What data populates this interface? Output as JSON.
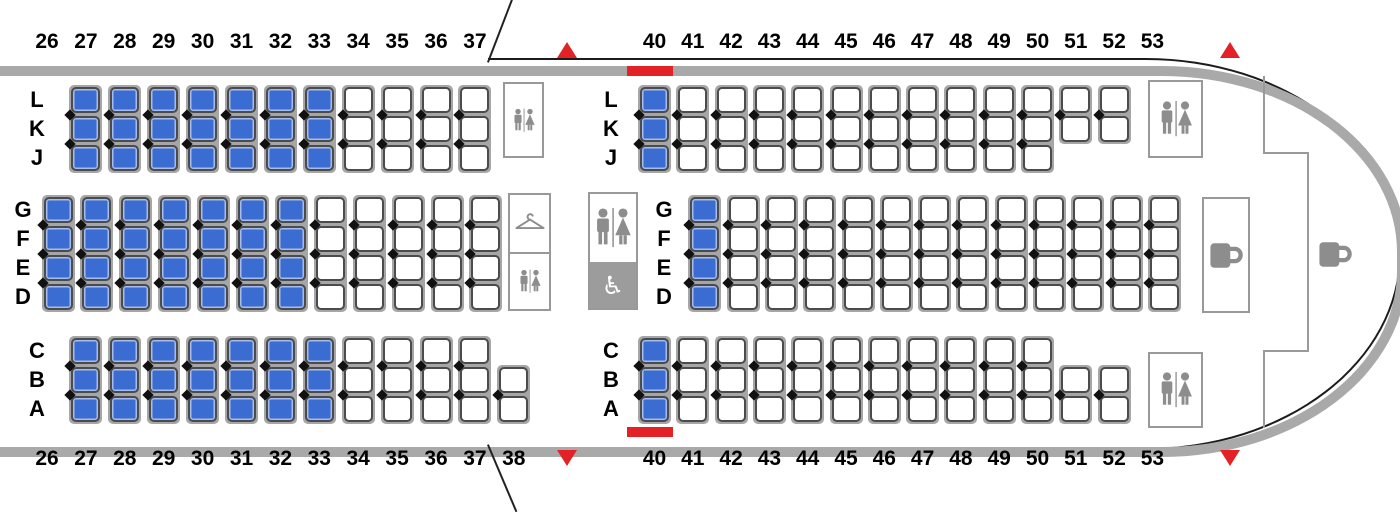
{
  "seat_map": {
    "colors": {
      "seat_highlight": "#3b6cd2",
      "seat_outline": "#4b4b4b",
      "seat_frame_gray": "#a6a6a6",
      "fuselage_gray": "#a9a9a9",
      "aft_outline_black": "#1c1c1c",
      "exit_red": "#e32227",
      "facility_border": "#999999",
      "icon_gray": "#8d8d8d",
      "accessible_lav_bg": "#9c9c9c"
    },
    "row_numbers": {
      "top_left": [
        "26",
        "27",
        "28",
        "29",
        "30",
        "31",
        "32",
        "33",
        "34",
        "35",
        "36",
        "37"
      ],
      "top_right": [
        "40",
        "41",
        "42",
        "43",
        "44",
        "45",
        "46",
        "47",
        "48",
        "49",
        "50",
        "51",
        "52",
        "53"
      ],
      "bottom_left": [
        "26",
        "27",
        "28",
        "29",
        "30",
        "31",
        "32",
        "33",
        "34",
        "35",
        "36",
        "37",
        "38"
      ],
      "bottom_right": [
        "40",
        "41",
        "42",
        "43",
        "44",
        "45",
        "46",
        "47",
        "48",
        "49",
        "50",
        "51",
        "52",
        "53"
      ]
    },
    "cabin_blocks": [
      {
        "id": "fwd-top",
        "letters": [
          "L",
          "K",
          "J"
        ],
        "columns": [
          {
            "row": 27,
            "slots": [
              0,
              1,
              2
            ],
            "highlighted": true
          },
          {
            "row": 28,
            "slots": [
              0,
              1,
              2
            ],
            "highlighted": true
          },
          {
            "row": 29,
            "slots": [
              0,
              1,
              2
            ],
            "highlighted": true
          },
          {
            "row": 30,
            "slots": [
              0,
              1,
              2
            ],
            "highlighted": true
          },
          {
            "row": 31,
            "slots": [
              0,
              1,
              2
            ],
            "highlighted": true
          },
          {
            "row": 32,
            "slots": [
              0,
              1,
              2
            ],
            "highlighted": true
          },
          {
            "row": 33,
            "slots": [
              0,
              1,
              2
            ],
            "highlighted": true
          },
          {
            "row": 34,
            "slots": [
              0,
              1,
              2
            ],
            "highlighted": false
          },
          {
            "row": 35,
            "slots": [
              0,
              1,
              2
            ],
            "highlighted": false
          },
          {
            "row": 36,
            "slots": [
              0,
              1,
              2
            ],
            "highlighted": false
          },
          {
            "row": 37,
            "slots": [
              0,
              1,
              2
            ],
            "highlighted": false
          }
        ]
      },
      {
        "id": "fwd-mid",
        "letters": [
          "G",
          "F",
          "E",
          "D"
        ],
        "columns": [
          {
            "row": 26,
            "slots": [
              0,
              1,
              2,
              3
            ],
            "highlighted": true
          },
          {
            "row": 27,
            "slots": [
              0,
              1,
              2,
              3
            ],
            "highlighted": true
          },
          {
            "row": 28,
            "slots": [
              0,
              1,
              2,
              3
            ],
            "highlighted": true
          },
          {
            "row": 29,
            "slots": [
              0,
              1,
              2,
              3
            ],
            "highlighted": true
          },
          {
            "row": 30,
            "slots": [
              0,
              1,
              2,
              3
            ],
            "highlighted": true
          },
          {
            "row": 31,
            "slots": [
              0,
              1,
              2,
              3
            ],
            "highlighted": true
          },
          {
            "row": 32,
            "slots": [
              0,
              1,
              2,
              3
            ],
            "highlighted": true
          },
          {
            "row": 33,
            "slots": [
              0,
              1,
              2,
              3
            ],
            "highlighted": false
          },
          {
            "row": 34,
            "slots": [
              0,
              1,
              2,
              3
            ],
            "highlighted": false
          },
          {
            "row": 35,
            "slots": [
              0,
              1,
              2,
              3
            ],
            "highlighted": false
          },
          {
            "row": 36,
            "slots": [
              0,
              1,
              2,
              3
            ],
            "highlighted": false
          },
          {
            "row": 37,
            "slots": [
              0,
              1,
              2,
              3
            ],
            "highlighted": false
          }
        ]
      },
      {
        "id": "fwd-bottom",
        "letters": [
          "C",
          "B",
          "A"
        ],
        "columns": [
          {
            "row": 27,
            "slots": [
              0,
              1,
              2
            ],
            "highlighted": true
          },
          {
            "row": 28,
            "slots": [
              0,
              1,
              2
            ],
            "highlighted": true
          },
          {
            "row": 29,
            "slots": [
              0,
              1,
              2
            ],
            "highlighted": true
          },
          {
            "row": 30,
            "slots": [
              0,
              1,
              2
            ],
            "highlighted": true
          },
          {
            "row": 31,
            "slots": [
              0,
              1,
              2
            ],
            "highlighted": true
          },
          {
            "row": 32,
            "slots": [
              0,
              1,
              2
            ],
            "highlighted": true
          },
          {
            "row": 33,
            "slots": [
              0,
              1,
              2
            ],
            "highlighted": true
          },
          {
            "row": 34,
            "slots": [
              0,
              1,
              2
            ],
            "highlighted": false
          },
          {
            "row": 35,
            "slots": [
              0,
              1,
              2
            ],
            "highlighted": false
          },
          {
            "row": 36,
            "slots": [
              0,
              1,
              2
            ],
            "highlighted": false
          },
          {
            "row": 37,
            "slots": [
              0,
              1,
              2
            ],
            "highlighted": false
          },
          {
            "row": 38,
            "slots": [
              1,
              2
            ],
            "highlighted": false
          }
        ]
      },
      {
        "id": "aft-top",
        "letters": [
          "L",
          "K",
          "J"
        ],
        "columns": [
          {
            "row": 40,
            "slots": [
              0,
              1,
              2
            ],
            "highlighted": true
          },
          {
            "row": 41,
            "slots": [
              0,
              1,
              2
            ],
            "highlighted": false
          },
          {
            "row": 42,
            "slots": [
              0,
              1,
              2
            ],
            "highlighted": false
          },
          {
            "row": 43,
            "slots": [
              0,
              1,
              2
            ],
            "highlighted": false
          },
          {
            "row": 44,
            "slots": [
              0,
              1,
              2
            ],
            "highlighted": false
          },
          {
            "row": 45,
            "slots": [
              0,
              1,
              2
            ],
            "highlighted": false
          },
          {
            "row": 46,
            "slots": [
              0,
              1,
              2
            ],
            "highlighted": false
          },
          {
            "row": 47,
            "slots": [
              0,
              1,
              2
            ],
            "highlighted": false
          },
          {
            "row": 48,
            "slots": [
              0,
              1,
              2
            ],
            "highlighted": false
          },
          {
            "row": 49,
            "slots": [
              0,
              1,
              2
            ],
            "highlighted": false
          },
          {
            "row": 50,
            "slots": [
              0,
              1,
              2
            ],
            "highlighted": false
          },
          {
            "row": 51,
            "slots": [
              0,
              1
            ],
            "highlighted": false
          },
          {
            "row": 52,
            "slots": [
              0,
              1
            ],
            "highlighted": false
          }
        ]
      },
      {
        "id": "aft-mid",
        "letters": [
          "G",
          "F",
          "E",
          "D"
        ],
        "columns": [
          {
            "row": 41,
            "slots": [
              0,
              1,
              2,
              3
            ],
            "highlighted": true
          },
          {
            "row": 42,
            "slots": [
              0,
              1,
              2,
              3
            ],
            "highlighted": false
          },
          {
            "row": 43,
            "slots": [
              0,
              1,
              2,
              3
            ],
            "highlighted": false
          },
          {
            "row": 44,
            "slots": [
              0,
              1,
              2,
              3
            ],
            "highlighted": false
          },
          {
            "row": 45,
            "slots": [
              0,
              1,
              2,
              3
            ],
            "highlighted": false
          },
          {
            "row": 46,
            "slots": [
              0,
              1,
              2,
              3
            ],
            "highlighted": false
          },
          {
            "row": 47,
            "slots": [
              0,
              1,
              2,
              3
            ],
            "highlighted": false
          },
          {
            "row": 48,
            "slots": [
              0,
              1,
              2,
              3
            ],
            "highlighted": false
          },
          {
            "row": 49,
            "slots": [
              0,
              1,
              2,
              3
            ],
            "highlighted": false
          },
          {
            "row": 50,
            "slots": [
              0,
              1,
              2,
              3
            ],
            "highlighted": false
          },
          {
            "row": 51,
            "slots": [
              0,
              1,
              2,
              3
            ],
            "highlighted": false
          },
          {
            "row": 52,
            "slots": [
              0,
              1,
              2,
              3
            ],
            "highlighted": false
          },
          {
            "row": 53,
            "slots": [
              0,
              1,
              2,
              3
            ],
            "highlighted": false
          }
        ]
      },
      {
        "id": "aft-bottom",
        "letters": [
          "C",
          "B",
          "A"
        ],
        "columns": [
          {
            "row": 40,
            "slots": [
              0,
              1,
              2
            ],
            "highlighted": true
          },
          {
            "row": 41,
            "slots": [
              0,
              1,
              2
            ],
            "highlighted": false
          },
          {
            "row": 42,
            "slots": [
              0,
              1,
              2
            ],
            "highlighted": false
          },
          {
            "row": 43,
            "slots": [
              0,
              1,
              2
            ],
            "highlighted": false
          },
          {
            "row": 44,
            "slots": [
              0,
              1,
              2
            ],
            "highlighted": false
          },
          {
            "row": 45,
            "slots": [
              0,
              1,
              2
            ],
            "highlighted": false
          },
          {
            "row": 46,
            "slots": [
              0,
              1,
              2
            ],
            "highlighted": false
          },
          {
            "row": 47,
            "slots": [
              0,
              1,
              2
            ],
            "highlighted": false
          },
          {
            "row": 48,
            "slots": [
              0,
              1,
              2
            ],
            "highlighted": false
          },
          {
            "row": 49,
            "slots": [
              0,
              1,
              2
            ],
            "highlighted": false
          },
          {
            "row": 50,
            "slots": [
              0,
              1,
              2
            ],
            "highlighted": false
          },
          {
            "row": 51,
            "slots": [
              1,
              2
            ],
            "highlighted": false
          },
          {
            "row": 52,
            "slots": [
              1,
              2
            ],
            "highlighted": false
          }
        ]
      }
    ],
    "facilities": [
      {
        "id": "forward-lavatory",
        "icon": "restroom-icon"
      },
      {
        "id": "mid-closet",
        "icon": "hanger-icon"
      },
      {
        "id": "mid-lavatory",
        "icon": "restroom-icon"
      },
      {
        "id": "center-lavatory",
        "icon": "restroom-icon"
      },
      {
        "id": "accessible-lavatory",
        "icon": "wheelchair-icon"
      },
      {
        "id": "aft-galley",
        "icon": "mug-icon"
      },
      {
        "id": "tail-galley",
        "icon": "mug-icon"
      },
      {
        "id": "tail-lavatory-top",
        "icon": "restroom-icon"
      },
      {
        "id": "tail-lavatory-bottom",
        "icon": "restroom-icon"
      }
    ],
    "exit_markers": {
      "up_arrows": 2,
      "down_arrows": 2,
      "door_bars": 2,
      "wheelchair_glyph": "♿"
    }
  }
}
